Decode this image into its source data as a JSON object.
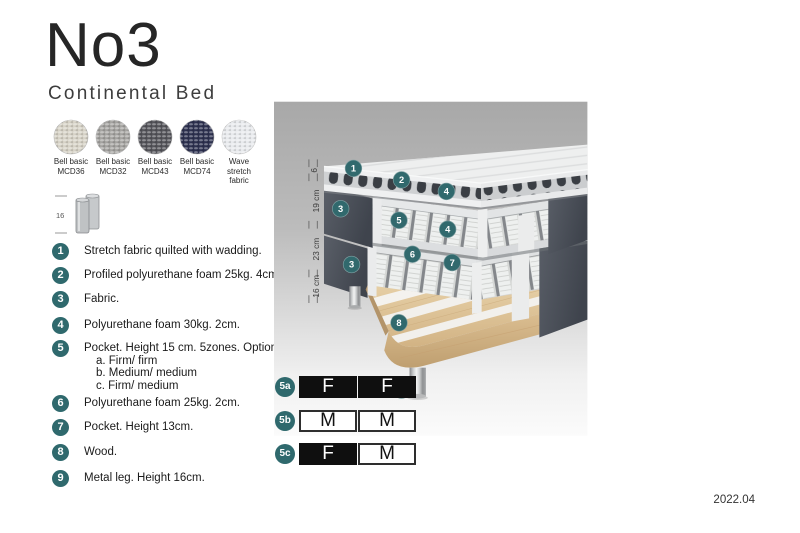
{
  "header": {
    "title": "No3",
    "subtitle": "Continental Bed"
  },
  "swatches": [
    {
      "name": "Bell basic",
      "code": "MCD36",
      "color": "#d6d2c6"
    },
    {
      "name": "Bell basic",
      "code": "MCD32",
      "color": "#a4a3a0"
    },
    {
      "name": "Bell basic",
      "code": "MCD43",
      "color": "#54545a"
    },
    {
      "name": "Bell basic",
      "code": "MCD74",
      "color": "#2d3150"
    },
    {
      "name": "Wave",
      "code": "stretch fabric",
      "color": "#e8eaed"
    }
  ],
  "leg_icon": {
    "dimension": "16"
  },
  "legend": {
    "items": [
      {
        "num": "1",
        "text": "Stretch fabric quilted with wadding."
      },
      {
        "num": "2",
        "text": "Profiled polyurethane foam 25kg. 4cm."
      },
      {
        "num": "3",
        "text": "Fabric."
      },
      {
        "num": "4",
        "text": "Polyurethane foam 30kg. 2cm."
      },
      {
        "num": "5",
        "text": "Pocket. Height 15 cm. 5zones. Option:",
        "options": [
          "a. Firm/ firm",
          "b. Medium/ medium",
          "c. Firm/ medium"
        ]
      },
      {
        "num": "6",
        "text": "Polyurethane foam 25kg. 2cm."
      },
      {
        "num": "7",
        "text": "Pocket. Height 13cm."
      },
      {
        "num": "8",
        "text": "Wood."
      },
      {
        "num": "9",
        "text": "Metal leg. Height 16cm."
      }
    ]
  },
  "diagram": {
    "dimensions": [
      "6",
      "19 cm",
      "23 cm",
      "16 cm"
    ],
    "callouts": [
      "1",
      "2",
      "4",
      "3",
      "5",
      "4",
      "6",
      "7",
      "3",
      "8",
      "9"
    ]
  },
  "firmness": {
    "rows": [
      {
        "id": "5a",
        "cells": [
          {
            "label": "F",
            "variant": "dark"
          },
          {
            "label": "F",
            "variant": "dark"
          }
        ]
      },
      {
        "id": "5b",
        "cells": [
          {
            "label": "M",
            "variant": "light"
          },
          {
            "label": "M",
            "variant": "light"
          }
        ]
      },
      {
        "id": "5c",
        "cells": [
          {
            "label": "F",
            "variant": "dark"
          },
          {
            "label": "M",
            "variant": "light"
          }
        ]
      }
    ]
  },
  "footer": {
    "version": "2022.04"
  },
  "colors": {
    "accent_teal": "#2f696d",
    "dark_fabric": "#4d525b",
    "wood": "#d9bd8f",
    "chrome": "#c9cbcc",
    "panel_top": "#a8a8a8",
    "panel_bottom": "#fbfbfb"
  }
}
